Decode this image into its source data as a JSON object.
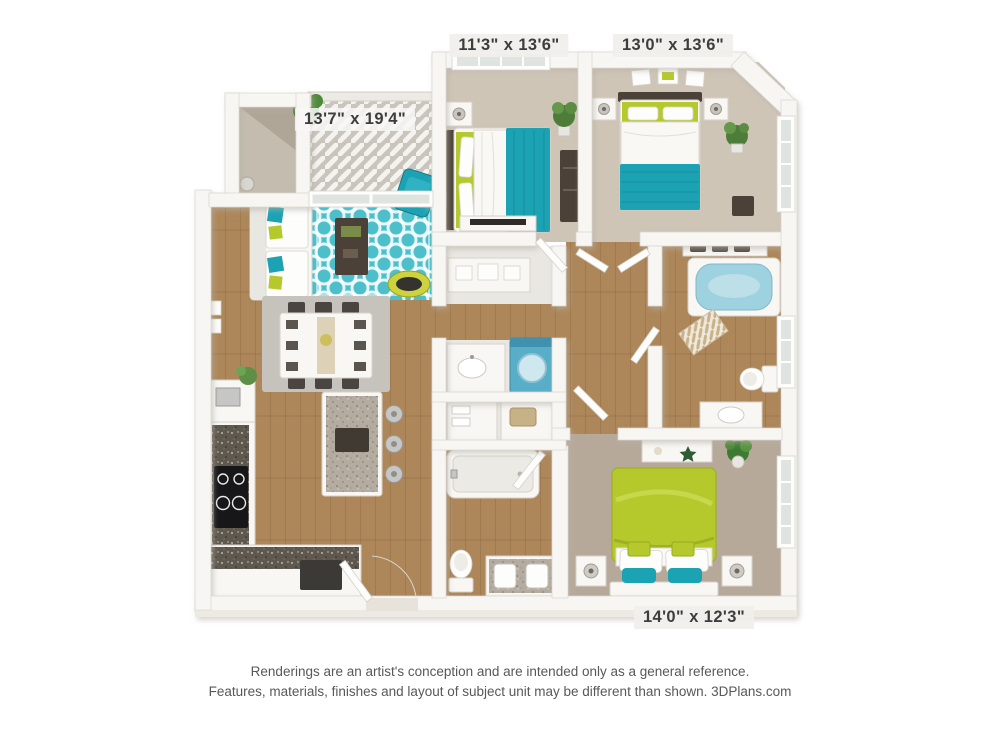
{
  "labels": {
    "bedroom_top_left_dims": "11'3\" x 13'6\"",
    "bedroom_top_right_dims": "13'0\" x 13'6\"",
    "living_area_dims": "13'7\" x 19'4\"",
    "bedroom_bottom_dims": "14'0\" x 12'3\""
  },
  "disclaimer": {
    "line1": "Renderings are an artist's conception and are intended only as a general reference.",
    "line2": "Features, materials, finishes and layout of subject unit may be different than shown. 3DPlans.com"
  },
  "colors": {
    "teal": "#1ba3b4",
    "teal_rug": "#4cbfca",
    "lime": "#b5c92d",
    "wood": "#ad8659",
    "carpet_light": "#cfc5b7",
    "carpet_dark": "#b7a999",
    "tile": "#e9e7e2",
    "washer_blue": "#57aec6",
    "tub_water": "#9ed2e0",
    "deck": "#c9c5bd",
    "dog_bed": "#cdd23e",
    "granite_dark": "#5f584f",
    "granite_light": "#b4aca0",
    "rug_gray": "#c6c3bd"
  }
}
